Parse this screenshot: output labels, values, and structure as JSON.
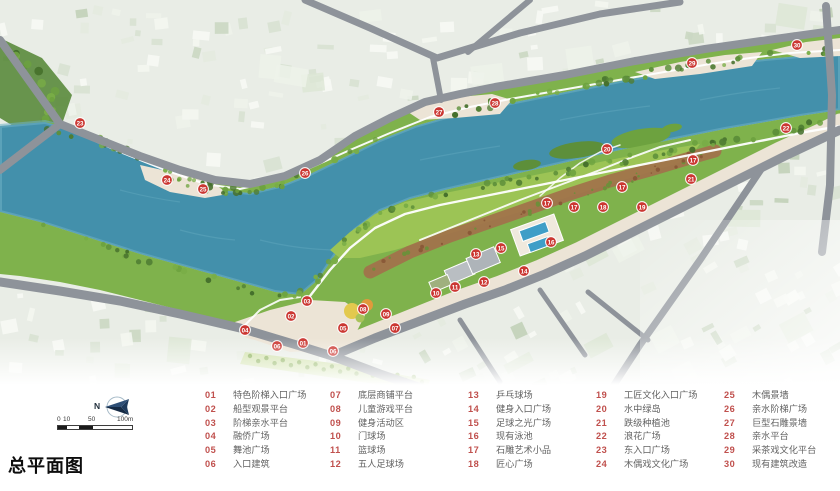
{
  "title": "总平面图",
  "compass": {
    "label": "N"
  },
  "scale_bar": {
    "tick_labels": [
      "0",
      "10",
      "50",
      "100m"
    ]
  },
  "legend": {
    "columns": [
      [
        {
          "num": "01",
          "label": "特色阶梯入口广场"
        },
        {
          "num": "02",
          "label": "船型观景平台"
        },
        {
          "num": "03",
          "label": "阶梯亲水平台"
        },
        {
          "num": "04",
          "label": "融侨广场"
        },
        {
          "num": "05",
          "label": "舞池广场"
        },
        {
          "num": "06",
          "label": "入口建筑"
        }
      ],
      [
        {
          "num": "07",
          "label": "底层商铺平台"
        },
        {
          "num": "08",
          "label": "儿童游戏平台"
        },
        {
          "num": "09",
          "label": "健身活动区"
        },
        {
          "num": "10",
          "label": "门球场"
        },
        {
          "num": "11",
          "label": "篮球场"
        },
        {
          "num": "12",
          "label": "五人足球场"
        }
      ],
      [
        {
          "num": "13",
          "label": "乒乓球场"
        },
        {
          "num": "14",
          "label": "健身入口广场"
        },
        {
          "num": "15",
          "label": "足球之光广场"
        },
        {
          "num": "16",
          "label": "现有泳池"
        },
        {
          "num": "17",
          "label": "石雕艺术小品"
        },
        {
          "num": "18",
          "label": "匠心广场"
        }
      ],
      [
        {
          "num": "19",
          "label": "工匠文化入口广场"
        },
        {
          "num": "20",
          "label": "水中绿岛"
        },
        {
          "num": "21",
          "label": "跌级种植池"
        },
        {
          "num": "22",
          "label": "浪花广场"
        },
        {
          "num": "23",
          "label": "东入口广场"
        },
        {
          "num": "24",
          "label": "木偶戏文化广场"
        }
      ],
      [
        {
          "num": "25",
          "label": "木偶景墙"
        },
        {
          "num": "26",
          "label": "亲水阶梯广场"
        },
        {
          "num": "27",
          "label": "巨型石雕景墙"
        },
        {
          "num": "28",
          "label": "亲水平台"
        },
        {
          "num": "29",
          "label": "采茶戏文化平台"
        },
        {
          "num": "30",
          "label": "现有建筑改造"
        }
      ]
    ]
  },
  "map": {
    "markers": [
      {
        "num": "01",
        "x": 303,
        "y": 343
      },
      {
        "num": "02",
        "x": 291,
        "y": 316
      },
      {
        "num": "03",
        "x": 307,
        "y": 301
      },
      {
        "num": "04",
        "x": 245,
        "y": 330
      },
      {
        "num": "05",
        "x": 343,
        "y": 328
      },
      {
        "num": "06",
        "x": 277,
        "y": 346
      },
      {
        "num": "06",
        "x": 333,
        "y": 351
      },
      {
        "num": "07",
        "x": 395,
        "y": 328
      },
      {
        "num": "08",
        "x": 363,
        "y": 309
      },
      {
        "num": "09",
        "x": 386,
        "y": 314
      },
      {
        "num": "10",
        "x": 436,
        "y": 293
      },
      {
        "num": "11",
        "x": 455,
        "y": 287
      },
      {
        "num": "12",
        "x": 484,
        "y": 282
      },
      {
        "num": "13",
        "x": 476,
        "y": 254
      },
      {
        "num": "14",
        "x": 524,
        "y": 271
      },
      {
        "num": "15",
        "x": 501,
        "y": 248
      },
      {
        "num": "16",
        "x": 551,
        "y": 242
      },
      {
        "num": "17",
        "x": 547,
        "y": 203
      },
      {
        "num": "17",
        "x": 574,
        "y": 207
      },
      {
        "num": "17",
        "x": 622,
        "y": 187
      },
      {
        "num": "17",
        "x": 693,
        "y": 160
      },
      {
        "num": "18",
        "x": 603,
        "y": 207
      },
      {
        "num": "19",
        "x": 642,
        "y": 207
      },
      {
        "num": "20",
        "x": 607,
        "y": 149
      },
      {
        "num": "21",
        "x": 691,
        "y": 179
      },
      {
        "num": "22",
        "x": 786,
        "y": 128
      },
      {
        "num": "23",
        "x": 80,
        "y": 123
      },
      {
        "num": "24",
        "x": 167,
        "y": 180
      },
      {
        "num": "25",
        "x": 203,
        "y": 189
      },
      {
        "num": "26",
        "x": 305,
        "y": 173
      },
      {
        "num": "27",
        "x": 439,
        "y": 112
      },
      {
        "num": "28",
        "x": 495,
        "y": 103
      },
      {
        "num": "29",
        "x": 692,
        "y": 63
      },
      {
        "num": "30",
        "x": 797,
        "y": 45
      }
    ],
    "colors": {
      "river": "#4390ab",
      "river_edge": "#6fb0c4",
      "park_green": "#7fb24c",
      "lawn_green": "#9cc455",
      "tree_dark": "#4f7d33",
      "terrace_brown": "#a2714b",
      "road_gray": "#8e939a",
      "promenade_beige": "#ece4d6",
      "city_base": "#e9ede6",
      "pool_blue": "#3f9ec7",
      "marker_red": "#cb3732",
      "legend_number": "#c0504d",
      "legend_text": "#636363",
      "compass_navy": "#1d3a5c"
    }
  }
}
